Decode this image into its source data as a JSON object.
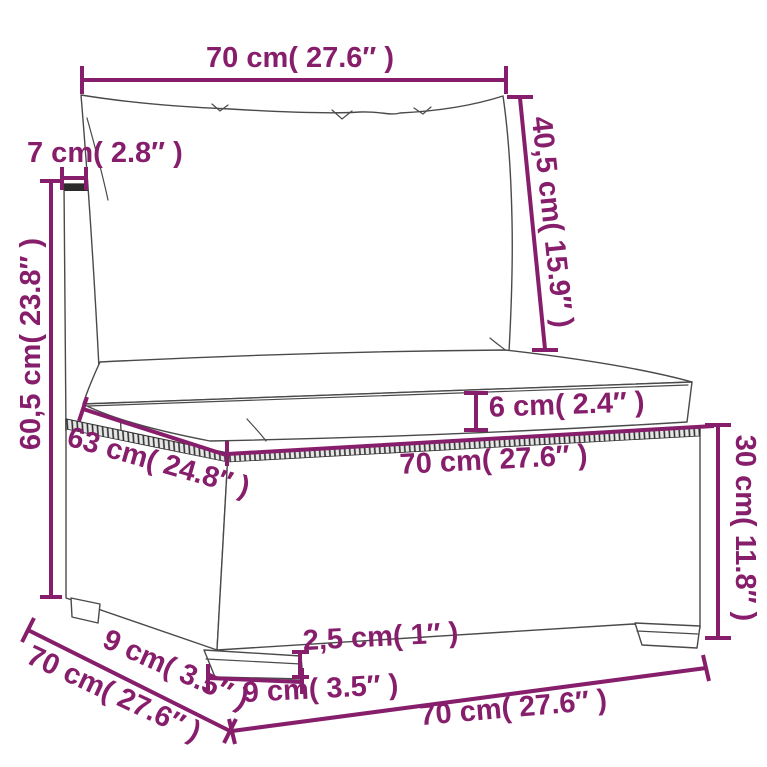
{
  "diagram": {
    "accent_color": "#871e6b",
    "outline_color": "#4a4a4a",
    "labels": {
      "top_width": "70 cm( 27.6″ )",
      "back_panel_thickness": "7 cm( 2.8″ )",
      "back_cushion_height": "40,5 cm( 15.9″ )",
      "total_height": "60,5 cm( 23.8″ )",
      "seat_cushion_thickness": "6 cm( 2.4″ )",
      "seat_depth": "63 cm( 24.8″ )",
      "seat_width": "70 cm( 27.6″ )",
      "base_height": "30 cm( 11.8″ )",
      "foot_height": "2,5 cm( 1″ )",
      "foot_width": "9 cm( 3.5″ )",
      "foot_depth": "9 cm( 3.5″ )",
      "total_depth": "70 cm( 27.6″ )",
      "bottom_width": "70 cm( 27.6″ )"
    }
  }
}
